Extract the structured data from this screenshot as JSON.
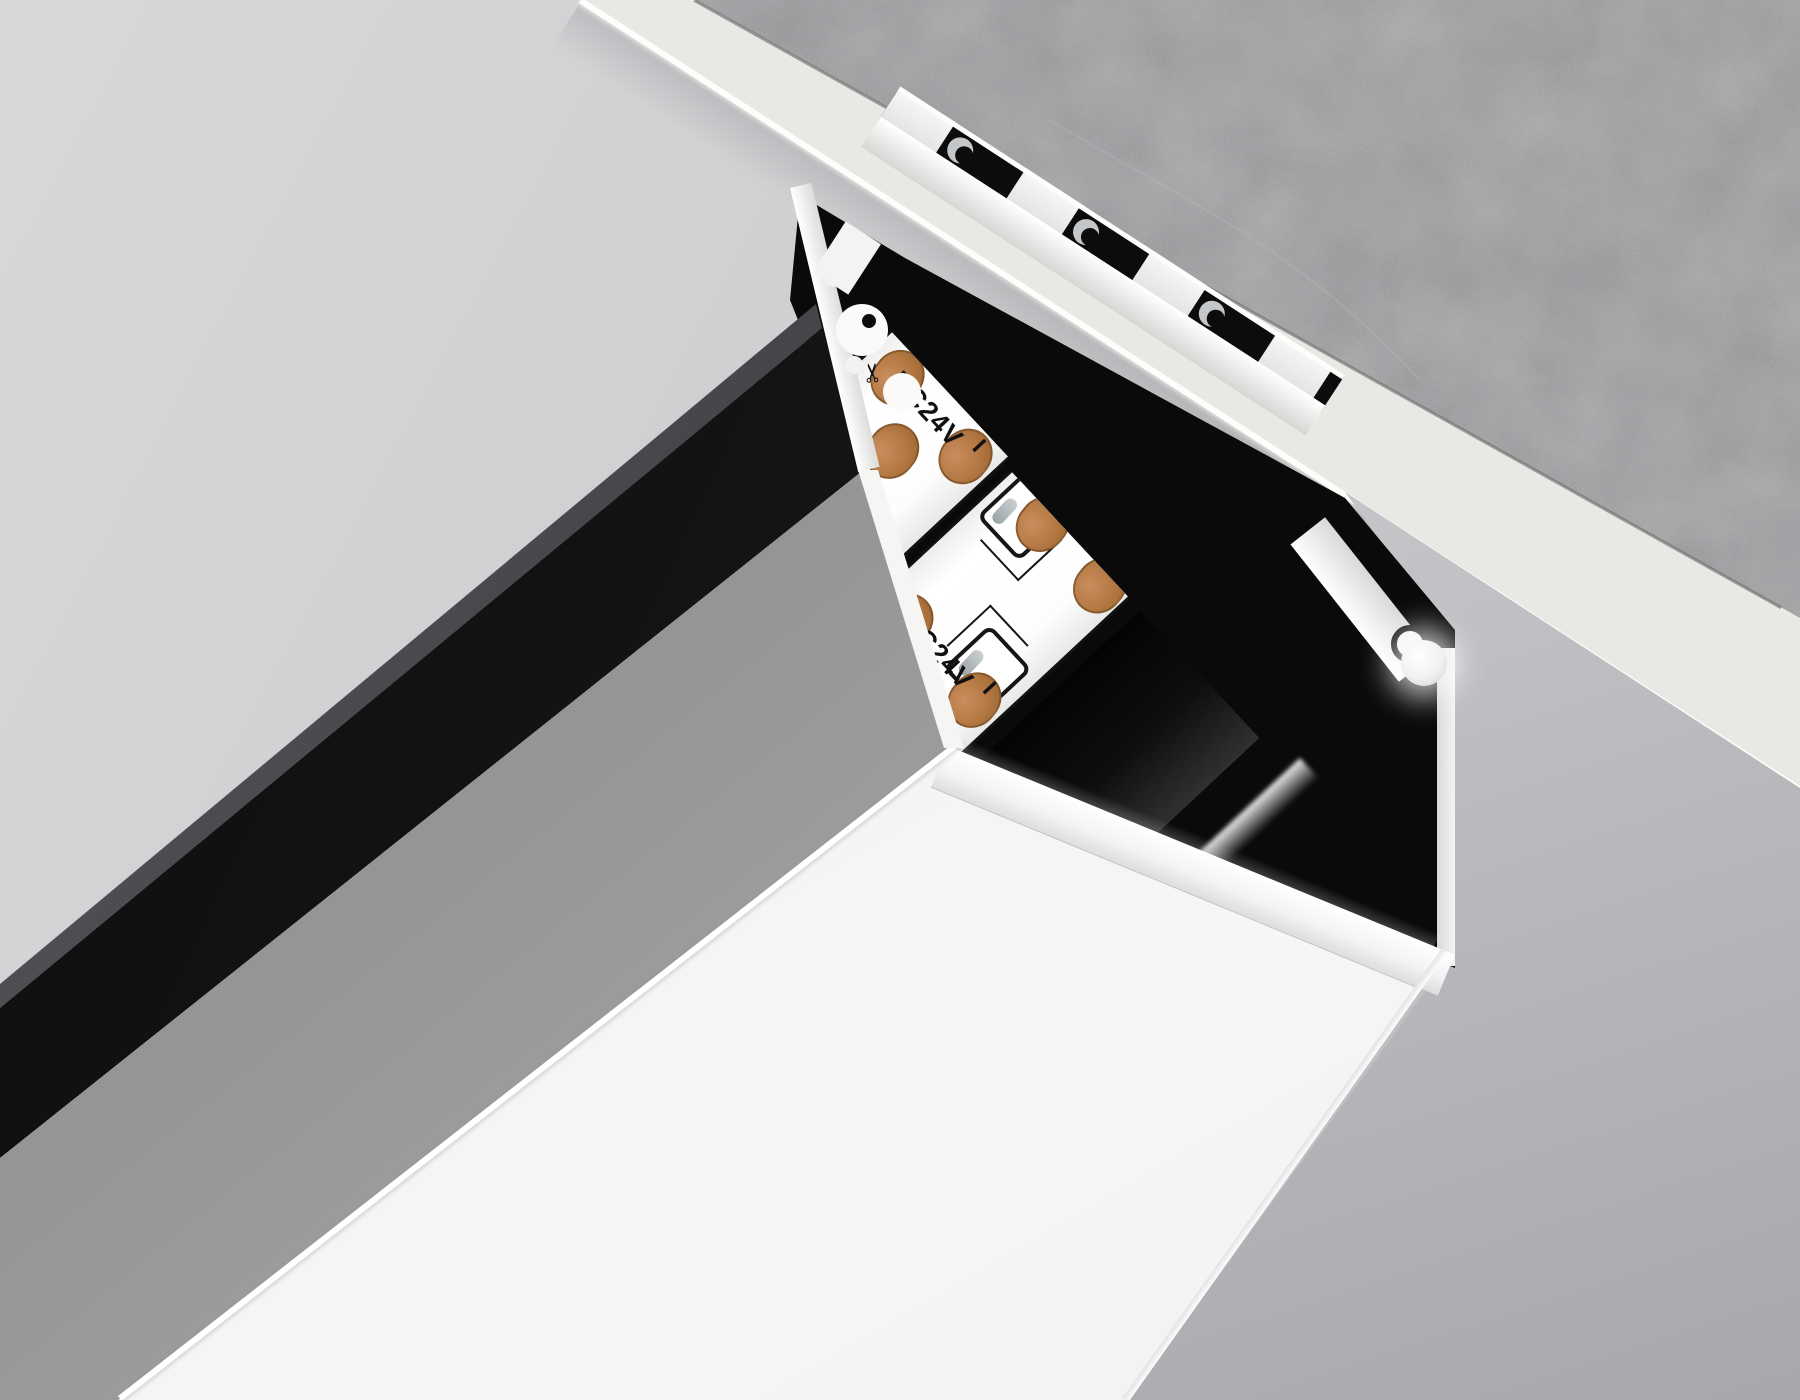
{
  "scene": {
    "type": "recessed-led-aluminum-profile-render",
    "surfaces": {
      "ceiling_plane": {
        "color_start": "#d7d8da",
        "color_end": "#b2b3b5"
      },
      "concrete_slab": {
        "base_color": "#8d8e90"
      },
      "plaster_cut_edge": {
        "base_color": "#eae9e5",
        "highlight": "#fdfdfa"
      },
      "recess_wall": {
        "color_start": "#dcdddf",
        "color_end": "#a7a8ac"
      },
      "profile_outer_wall": {
        "color": "#141414"
      },
      "diffuser_side": {
        "color_start": "#828385",
        "color_end": "#b5b6b8"
      },
      "diffuser_face": {
        "color_start": "#e7e7e8",
        "color_end": "#f6f6f7"
      },
      "aluminum_cut_face": {
        "color": "#f4f4f3"
      }
    },
    "serration": {
      "notch_count": 3,
      "tab_pitch": 150,
      "tab_width": 66,
      "notch_color": "#0c0c0c"
    },
    "led_strips": {
      "pcb_color": "#fdfdfd",
      "brand": "AMBRELLA LIGHT",
      "voltage_label": "DC24V",
      "plus_label": "+",
      "minus_label": "−",
      "resistor_label": "151",
      "scissors_icon": "✂",
      "pad_color": "#b0753f",
      "strips": [
        {
          "id": "strip-1",
          "marks_offset": 0,
          "leds_top": [
            148,
            332
          ],
          "leds_bottom": [
            240,
            424
          ],
          "resistors": [
            [
              196,
              18
            ],
            [
              382,
              104
            ]
          ],
          "pads": [
            [
              -2,
              12
            ],
            [
              52,
              62
            ],
            [
              2,
              116
            ]
          ],
          "brand_right": 230
        },
        {
          "id": "strip-2",
          "marks_offset": 150,
          "leds_top": [
            -8,
            268,
            452
          ],
          "leds_bottom": [
            120,
            360
          ],
          "resistors": [
            [
              222,
              104
            ],
            [
              400,
              16
            ]
          ],
          "pads": [
            [
              150,
              12
            ],
            [
              202,
              62
            ],
            [
              154,
              116
            ],
            [
              -16,
              34
            ],
            [
              -16,
              118
            ]
          ],
          "brand_right": 300
        }
      ]
    }
  }
}
